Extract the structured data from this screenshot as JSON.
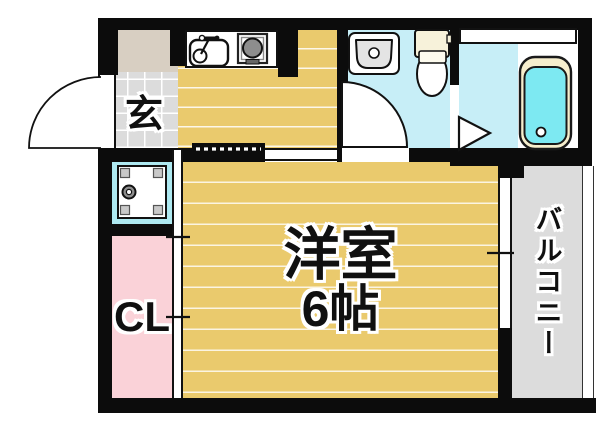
{
  "rooms": {
    "genkan_label": "玄",
    "closet_label": "CL",
    "main_room_label_line1": "洋室",
    "main_room_label_line2": "6帖",
    "balcony_label": "バルコニー"
  },
  "icons": [
    "entrance-door-arc",
    "kitchen-sink",
    "gas-stove",
    "wash-basin",
    "toilet",
    "bathtub",
    "folding-door",
    "washing-machine-pan",
    "sliding-window",
    "closet-sliding-door",
    "open-doorway-dashed"
  ],
  "colors": {
    "floor_tan": "#eaca6d",
    "bath_cyan": "#c7eef7",
    "tub_cyan": "#7de9f2",
    "closet_pink": "#fad2d8",
    "balcony_gray": "#dcdcdc",
    "storage_beige": "#d8cfc2",
    "pan_cyan": "#aee9f1",
    "wall_black": "#0c0c0c"
  }
}
